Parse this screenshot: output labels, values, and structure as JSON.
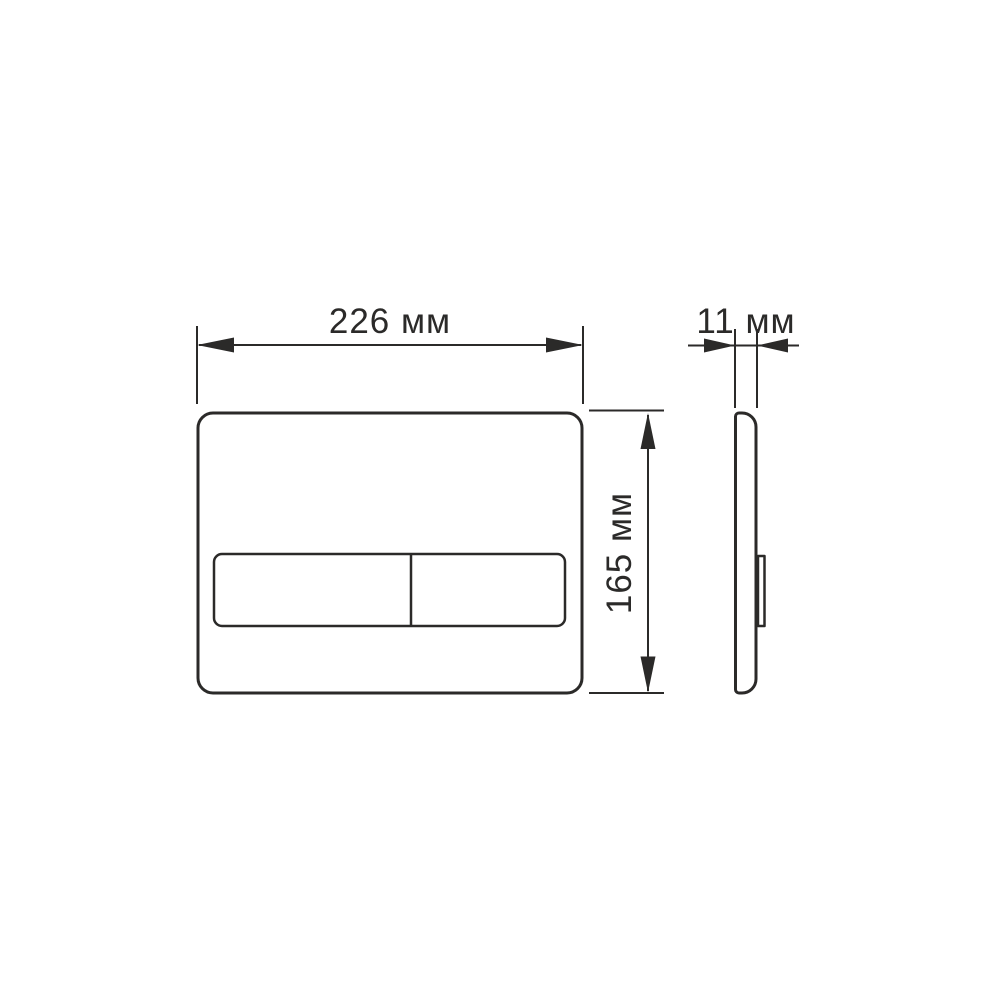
{
  "diagram": {
    "title": "flush plate dimension drawing",
    "colors": {
      "line": "#2b2a29",
      "background": "#ffffff"
    },
    "dimensions": {
      "width": {
        "label": "226 мм",
        "value": 226,
        "unit": "мм"
      },
      "thickness": {
        "label": "11 мм",
        "value": 11,
        "unit": "мм"
      },
      "height": {
        "label": "165 мм",
        "value": 165,
        "unit": "мм"
      }
    }
  }
}
